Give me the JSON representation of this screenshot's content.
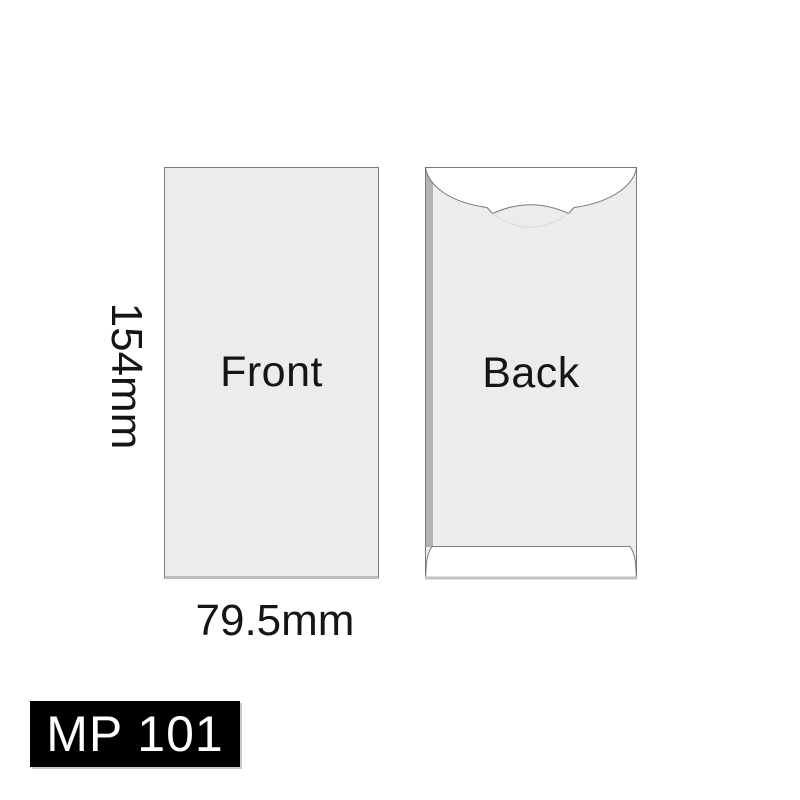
{
  "diagram": {
    "title": "Envelope product dimension diagram",
    "front_panel": {
      "label": "Front"
    },
    "back_panel": {
      "label": "Back"
    },
    "dimensions": {
      "height_label": "154mm",
      "width_label": "79.5mm"
    }
  },
  "badge": {
    "model_label": "MP 101"
  },
  "colors": {
    "bg": "#ffffff",
    "panel-fill": "#ececec",
    "line": "#7a7a7a",
    "seam": "#b3b3b3",
    "band": "#c2c2c2",
    "crease": "#d9d9d9",
    "text": "#151515",
    "badge-bg": "#000000",
    "badge-text": "#ffffff",
    "badge-shadow": "#c9c9c9"
  }
}
